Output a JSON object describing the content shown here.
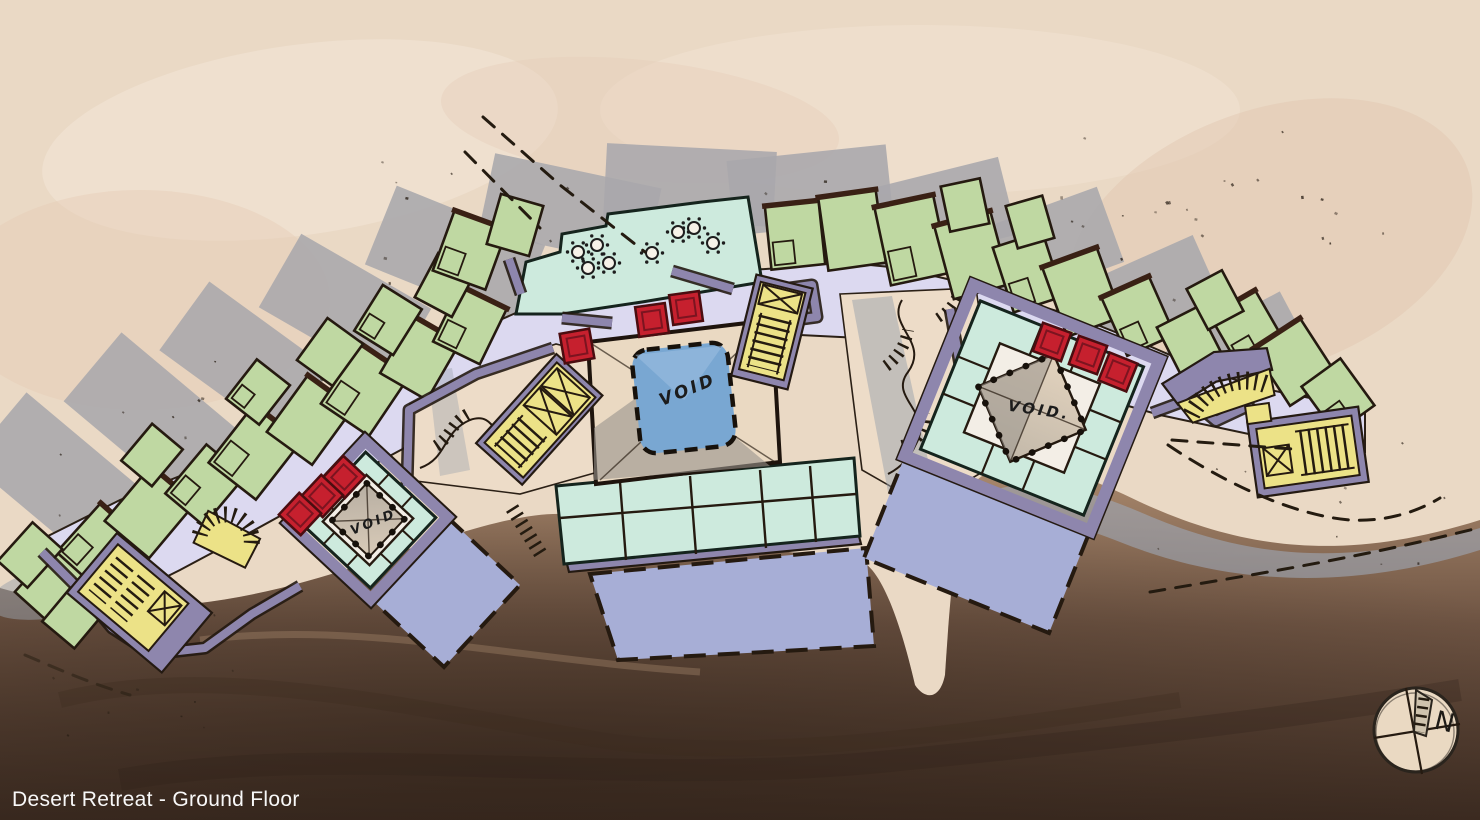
{
  "title": "Desert Retreat - Ground Floor",
  "plan": {
    "courtyards": [
      {
        "id": "left",
        "label": "VOID"
      },
      {
        "id": "center",
        "label": "VOID"
      },
      {
        "id": "right",
        "label": "VOID."
      }
    ],
    "compass_label": "N"
  },
  "palette": {
    "terrain_sand": "#ead9c5",
    "terrain_rock_mid": "#8a6e5a",
    "terrain_rock_dark": "#46332a",
    "shadow_gray": "#a8a7ac",
    "building_green": "#bfd8a2",
    "path_lavender": "#dcd9f0",
    "terrace_teal": "#cdeadd",
    "deck_periwinkle": "#a7aed6",
    "void_blue": "#79a7d2",
    "accent_red": "#c6202e",
    "stair_yellow": "#ece287",
    "wall_purple": "#8e86ad",
    "ink": "#251a10",
    "title_white": "#ffffff"
  }
}
